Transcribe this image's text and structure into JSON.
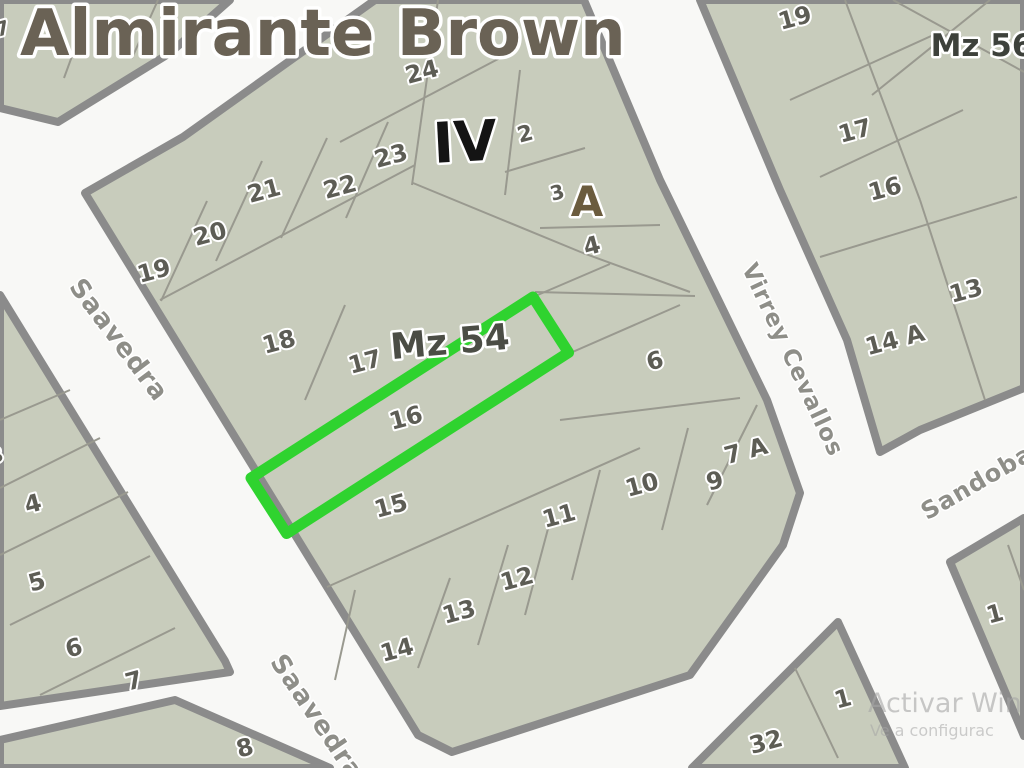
{
  "title": {
    "text": "Almirante Brown",
    "x": 20,
    "y": 55,
    "size": 64
  },
  "watermark": {
    "line1": {
      "text": "Activar Win",
      "x": 868,
      "y": 712,
      "size": 27
    },
    "line2": {
      "text": "Ve a configurac",
      "x": 870,
      "y": 736,
      "size": 16
    }
  },
  "colors": {
    "street_bg": "#f8f8f6",
    "block_fill": "#c8ccbc",
    "block_stroke": "#8b8b8b",
    "divider": "#99998f",
    "lot_text": "#5d5d55",
    "street_text": "#8e8e88",
    "title_text": "#6a6255",
    "highlight_green": "#2fd32f",
    "watermark_text": "#a6a6a6",
    "label_iv": "#141414",
    "label_a": "#6b5c3e",
    "label_mz54": "#4b4d45",
    "label_mz56": "#3d413b"
  },
  "map": {
    "width": 1024,
    "height": 768,
    "blocks": [
      {
        "id": "top-left-strip",
        "points": "0,0 230,0 170,53 58,122 0,108"
      },
      {
        "id": "mz54-central",
        "points": "183,137 375,0 584,0 660,180 767,400 800,493 783,545 690,675 452,752 418,735 85,193"
      },
      {
        "id": "mz56-east",
        "points": "700,0 1024,0 1024,388 920,430 880,452 847,340 780,190"
      },
      {
        "id": "west-strip",
        "points": "0,295 225,661 230,672 0,706"
      },
      {
        "id": "southwest-corner",
        "points": "175,700 330,768 0,768 0,740"
      },
      {
        "id": "south-center",
        "points": "838,622 905,768 692,768"
      },
      {
        "id": "southeast-sandobal",
        "points": "950,562 1024,518 1024,736"
      }
    ],
    "dividers": [
      [
        207,
        201,
        161,
        301
      ],
      [
        262,
        161,
        216,
        261
      ],
      [
        327,
        138,
        281,
        238
      ],
      [
        388,
        122,
        346,
        218
      ],
      [
        340,
        142,
        500,
        58
      ],
      [
        438,
        0,
        412,
        185
      ],
      [
        160,
        300,
        415,
        165
      ],
      [
        345,
        305,
        305,
        400
      ],
      [
        520,
        70,
        505,
        195
      ],
      [
        505,
        172,
        585,
        148
      ],
      [
        413,
        183,
        583,
        253
      ],
      [
        583,
        253,
        690,
        292
      ],
      [
        540,
        228,
        660,
        225
      ],
      [
        535,
        292,
        695,
        296
      ],
      [
        560,
        420,
        740,
        398
      ],
      [
        533,
        297,
        610,
        264
      ],
      [
        568,
        354,
        680,
        305
      ],
      [
        327,
        587,
        640,
        448
      ],
      [
        355,
        590,
        335,
        680
      ],
      [
        450,
        578,
        418,
        668
      ],
      [
        508,
        545,
        478,
        645
      ],
      [
        553,
        510,
        525,
        615
      ],
      [
        600,
        470,
        572,
        580
      ],
      [
        688,
        428,
        662,
        530
      ],
      [
        757,
        405,
        707,
        505
      ],
      [
        845,
        0,
        920,
        200
      ],
      [
        920,
        200,
        985,
        400
      ],
      [
        790,
        100,
        940,
        32
      ],
      [
        820,
        177,
        963,
        110
      ],
      [
        820,
        257,
        1017,
        197
      ],
      [
        893,
        0,
        1024,
        72
      ],
      [
        990,
        0,
        872,
        95
      ],
      [
        0,
        420,
        70,
        390
      ],
      [
        0,
        488,
        100,
        438
      ],
      [
        0,
        555,
        128,
        492
      ],
      [
        10,
        625,
        150,
        556
      ],
      [
        40,
        695,
        175,
        628
      ],
      [
        86,
        18,
        64,
        78
      ],
      [
        158,
        0,
        132,
        58
      ],
      [
        795,
        668,
        838,
        758
      ],
      [
        1008,
        545,
        1024,
        590
      ]
    ],
    "highlight": {
      "x": 251,
      "y": 478,
      "width": 335,
      "height": 66,
      "rotate": -32.7
    },
    "block_labels": [
      {
        "text": "Mz 54",
        "x": 451,
        "y": 341,
        "size": 36,
        "rot": -5,
        "colorKey": "label_mz54"
      },
      {
        "text": "Mz 56",
        "x": 982,
        "y": 45,
        "size": 31,
        "rot": 0,
        "colorKey": "label_mz56"
      },
      {
        "text": "IV",
        "x": 466,
        "y": 141,
        "size": 56,
        "rot": -3,
        "colorKey": "label_iv"
      },
      {
        "text": "A",
        "x": 587,
        "y": 201,
        "size": 42,
        "rot": 0,
        "colorKey": "label_a"
      }
    ],
    "lot_labels": [
      {
        "text": "24",
        "x": 424,
        "y": 71
      },
      {
        "text": "23",
        "x": 393,
        "y": 155
      },
      {
        "text": "22",
        "x": 342,
        "y": 186
      },
      {
        "text": "21",
        "x": 266,
        "y": 190
      },
      {
        "text": "20",
        "x": 212,
        "y": 233
      },
      {
        "text": "19",
        "x": 156,
        "y": 270
      },
      {
        "text": "18",
        "x": 281,
        "y": 341
      },
      {
        "text": "17",
        "x": 367,
        "y": 361
      },
      {
        "text": "16",
        "x": 408,
        "y": 417
      },
      {
        "text": "15",
        "x": 393,
        "y": 505
      },
      {
        "text": "14",
        "x": 399,
        "y": 649
      },
      {
        "text": "13",
        "x": 461,
        "y": 611
      },
      {
        "text": "12",
        "x": 519,
        "y": 578
      },
      {
        "text": "11",
        "x": 561,
        "y": 515
      },
      {
        "text": "10",
        "x": 644,
        "y": 484
      },
      {
        "text": "9",
        "x": 717,
        "y": 480
      },
      {
        "text": "7 A",
        "x": 748,
        "y": 450
      },
      {
        "text": "6",
        "x": 657,
        "y": 360
      },
      {
        "text": "4",
        "x": 594,
        "y": 245
      },
      {
        "text": "3",
        "x": 559,
        "y": 192,
        "size": 20
      },
      {
        "text": "2",
        "x": 527,
        "y": 133,
        "size": 22
      },
      {
        "text": "19",
        "x": 797,
        "y": 17
      },
      {
        "text": "17",
        "x": 857,
        "y": 130
      },
      {
        "text": "16",
        "x": 887,
        "y": 188
      },
      {
        "text": "13",
        "x": 968,
        "y": 290
      },
      {
        "text": "14 A",
        "x": 897,
        "y": 339
      },
      {
        "text": "1",
        "x": 997,
        "y": 613
      },
      {
        "text": "1",
        "x": 845,
        "y": 698
      },
      {
        "text": "32",
        "x": 768,
        "y": 741
      },
      {
        "text": "4",
        "x": 35,
        "y": 503
      },
      {
        "text": "5",
        "x": 39,
        "y": 581
      },
      {
        "text": "6",
        "x": 76,
        "y": 647
      },
      {
        "text": "7",
        "x": 136,
        "y": 680
      },
      {
        "text": "8",
        "x": 247,
        "y": 747
      },
      {
        "text": "3",
        "x": -2,
        "y": 455,
        "size": 20
      },
      {
        "text": "7",
        "x": 4,
        "y": 28,
        "size": 20
      }
    ],
    "street_labels": [
      {
        "text": "Saavedra",
        "x": 112,
        "y": 345,
        "rot": 53,
        "size": 26
      },
      {
        "text": "Saavedra",
        "x": 310,
        "y": 722,
        "rot": 56,
        "size": 26
      },
      {
        "text": "Virrey Cevallos",
        "x": 786,
        "y": 363,
        "rot": 65,
        "size": 23
      },
      {
        "text": "Sandobal",
        "x": 985,
        "y": 487,
        "rot": -30,
        "size": 24
      }
    ]
  }
}
